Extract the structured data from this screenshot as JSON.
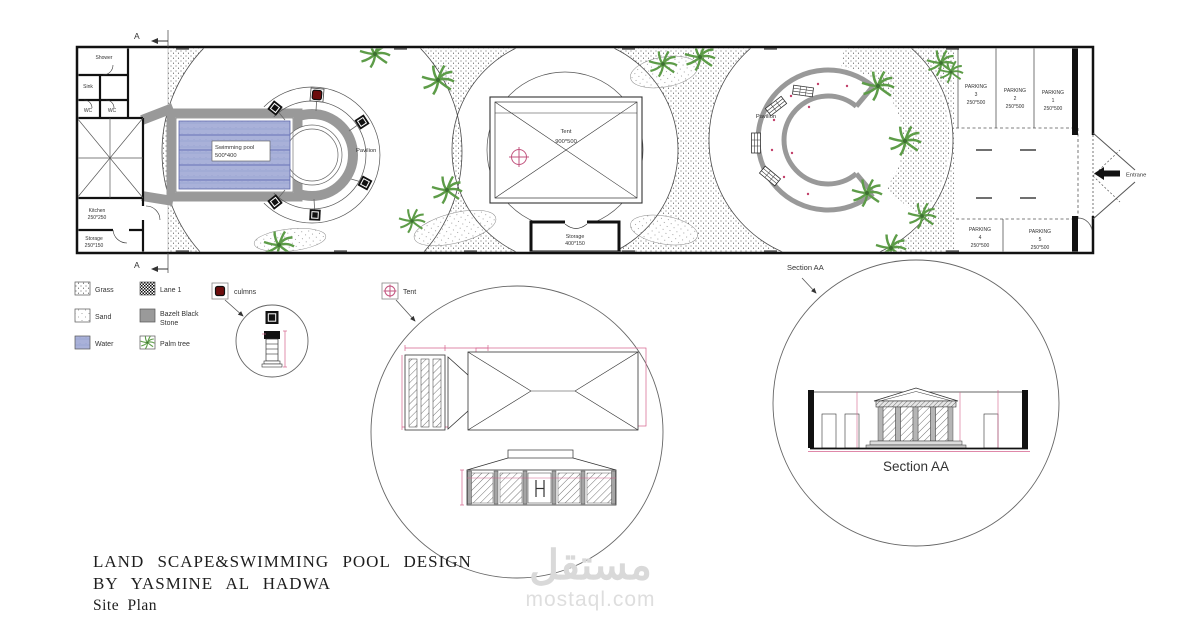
{
  "title_block": {
    "line1": "LAND SCAPE&SWIMMING POOL DESIGN",
    "line2": "BY YASMINE AL HADWA",
    "line3": "Site Plan"
  },
  "watermark": {
    "arabic": "مستقل",
    "latin": "mostaql.com"
  },
  "plan": {
    "section_marker": "A",
    "entrance_label": "Entrane",
    "rooms": {
      "shower": "Shower",
      "sink": "Sink",
      "wc": "WC",
      "kitchen_name": "Kitchen",
      "kitchen_dims": "250*250",
      "storage_name": "Storage",
      "storage_dims": "250*150"
    },
    "pool": {
      "name": "Swimming pool",
      "dims": "500*400"
    },
    "pavilion_left": "Pavilion",
    "pavilion_right": "Pavilion",
    "tent": {
      "name": "Tent",
      "dims": "900*500"
    },
    "storage_center": {
      "name": "Storage",
      "dims": "400*150"
    },
    "parking": [
      {
        "label": "PARKING",
        "num": "3",
        "dims": "250*500"
      },
      {
        "label": "PARKING",
        "num": "2",
        "dims": "250*500"
      },
      {
        "label": "PARKING",
        "num": "1",
        "dims": "250*500"
      },
      {
        "label": "PARKING",
        "num": "4",
        "dims": "250*500"
      },
      {
        "label": "PARKING",
        "num": "5",
        "dims": "250*500"
      }
    ]
  },
  "legend": {
    "grass": "Grass",
    "sand": "Sand",
    "water": "Water",
    "lane": "Lane 1",
    "bazelt_line1": "Bazelt Black",
    "bazelt_line2": "Stone",
    "palm": "Palm tree",
    "columns": "culmns",
    "tent": "Tent"
  },
  "section": {
    "callout": "Section AA",
    "caption": "Section AA"
  },
  "colors": {
    "water_fill": "#a9b1d9",
    "palm_green": "#5d9c48",
    "column_red": "#6d0d0d",
    "dim_pink": "#d4608c",
    "deck_gray": "#999999",
    "watermark_gray": "#d9d9d9"
  }
}
